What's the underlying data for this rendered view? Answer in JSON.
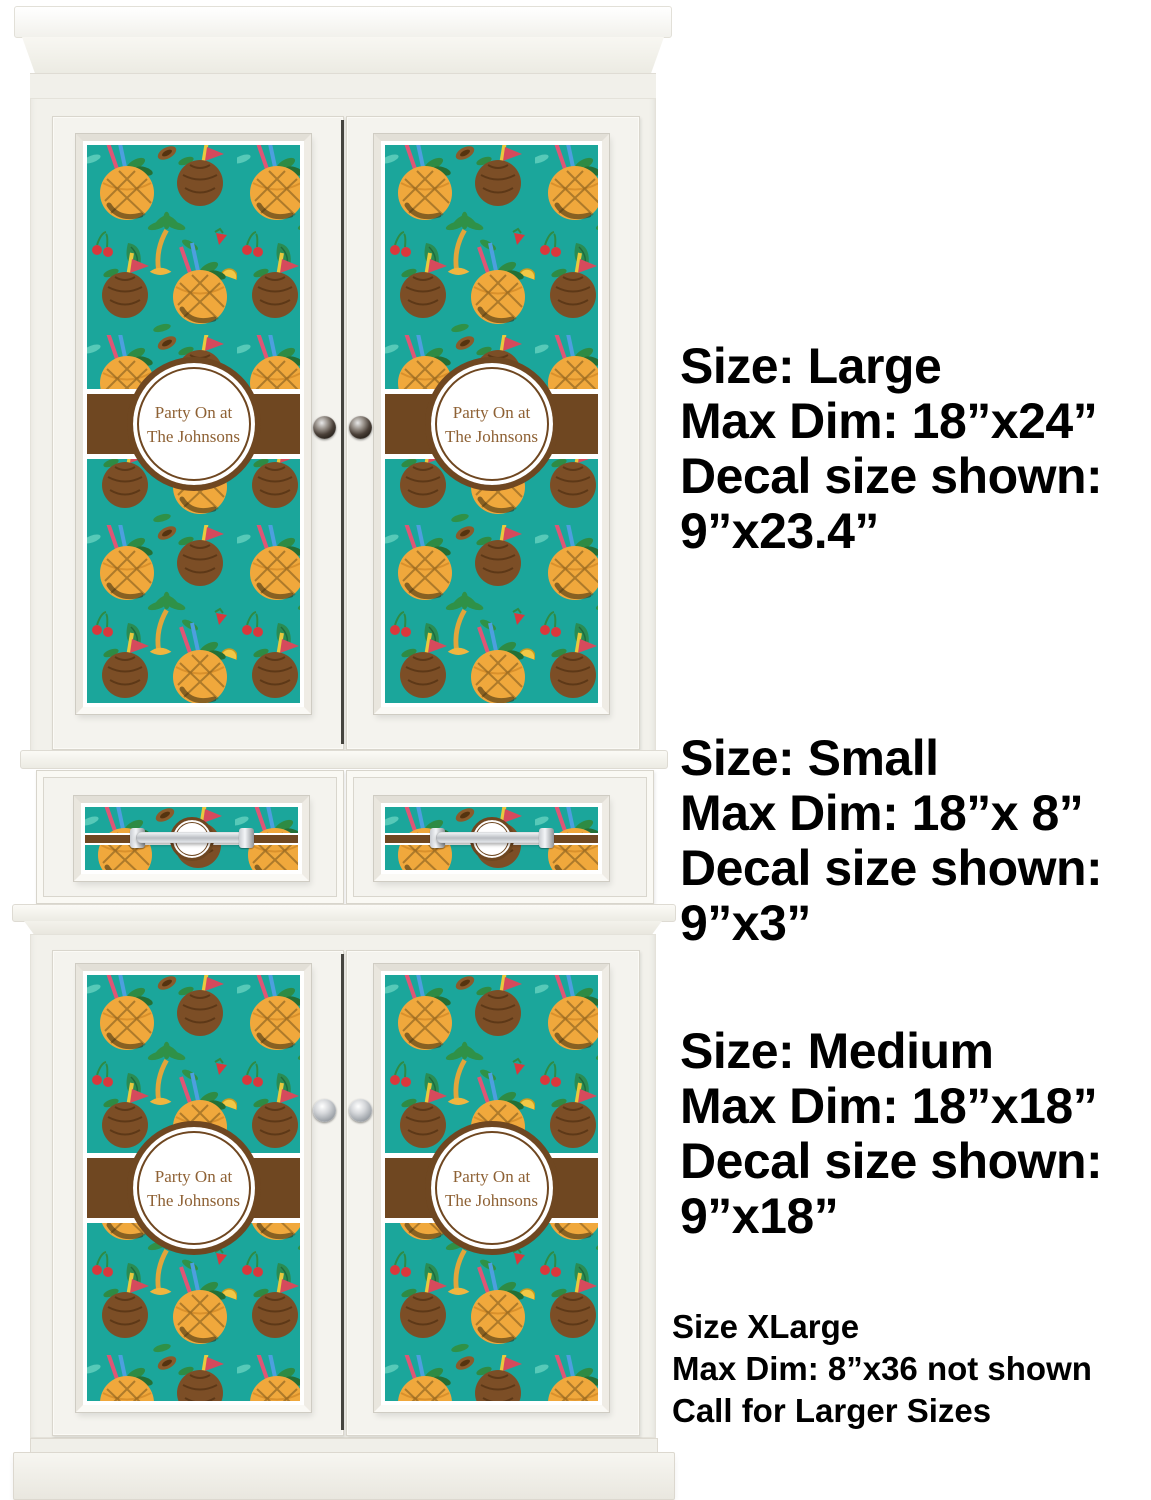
{
  "colors": {
    "teal": "#1BA69B",
    "band_brown": "#6F4721",
    "label_brown": "#8E6134",
    "annotation_black": "#000000",
    "cabinet_white": "#F2F1EB"
  },
  "decal_label": {
    "line1": "Party On at",
    "line2": "The Johnsons"
  },
  "drawer_decal_label": "Party On at",
  "annotations": {
    "large": {
      "lines": [
        "Size: Large",
        "Max Dim: 18”x24”",
        "Decal size shown:",
        "9”x23.4”"
      ]
    },
    "small": {
      "lines": [
        "Size: Small",
        "Max Dim: 18”x 8”",
        "Decal size shown:",
        "9”x3”"
      ]
    },
    "medium": {
      "lines": [
        "Size: Medium",
        "Max Dim: 18”x18”",
        "Decal size shown:",
        "9”x18”"
      ]
    },
    "xlarge": {
      "lines": [
        "Size XLarge",
        "Max Dim: 8”x36 not shown",
        "Call for Larger Sizes"
      ]
    }
  }
}
